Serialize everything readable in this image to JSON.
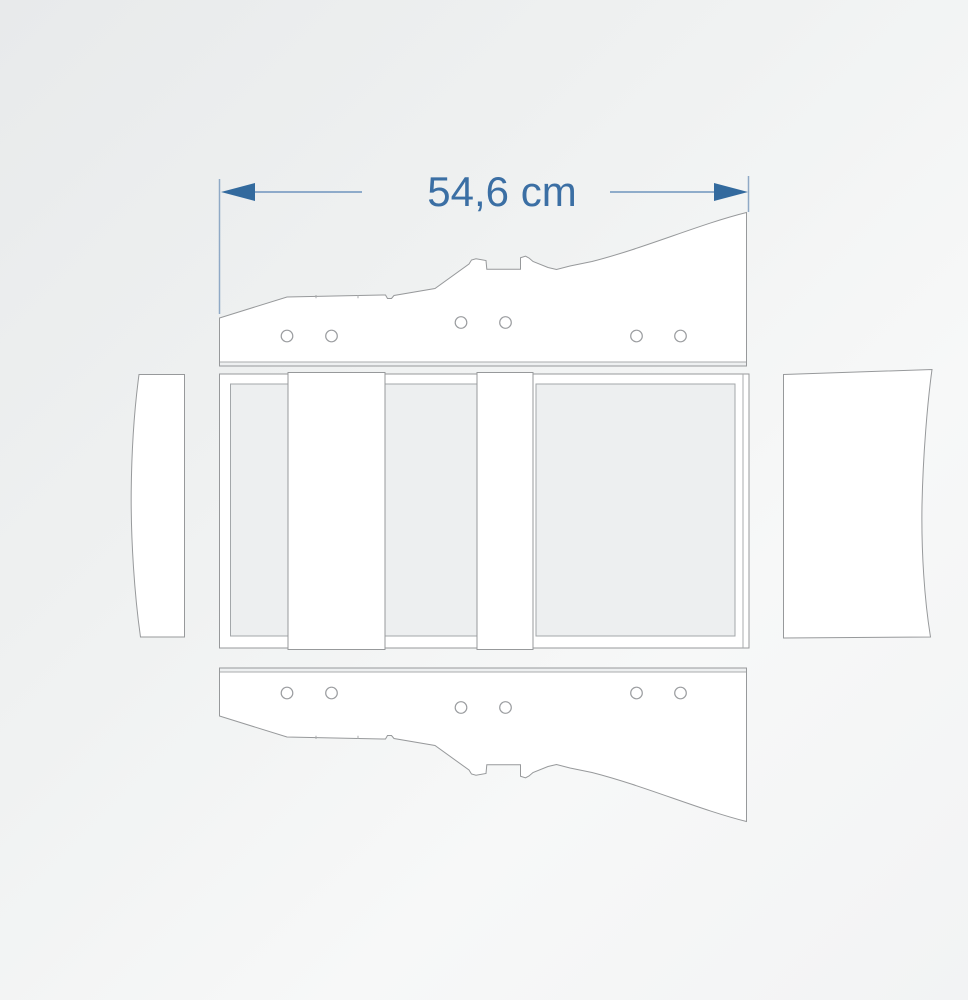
{
  "dimension": {
    "label": "54,6 cm"
  },
  "colors": {
    "dimension_text": "#3b6fa4",
    "dimension_arrow": "#336a9e",
    "dimension_line": "#6f94bd",
    "extension_line": "#8fa9c6",
    "part_outline": "#97999b",
    "part_fill": "#ffffff",
    "panel_fill": "#edeff0",
    "background_dark": "#e8eaeb",
    "background_light": "#f7f8f8"
  },
  "parts": {
    "side_panel_top": {
      "screw_holes": 6
    },
    "side_panel_bottom": {
      "screw_holes": 6
    },
    "frame_top_view": {
      "cross_boards": 2
    },
    "end_panel_left": {
      "screw_holes": 0
    },
    "end_panel_right": {
      "screw_holes": 0
    }
  }
}
